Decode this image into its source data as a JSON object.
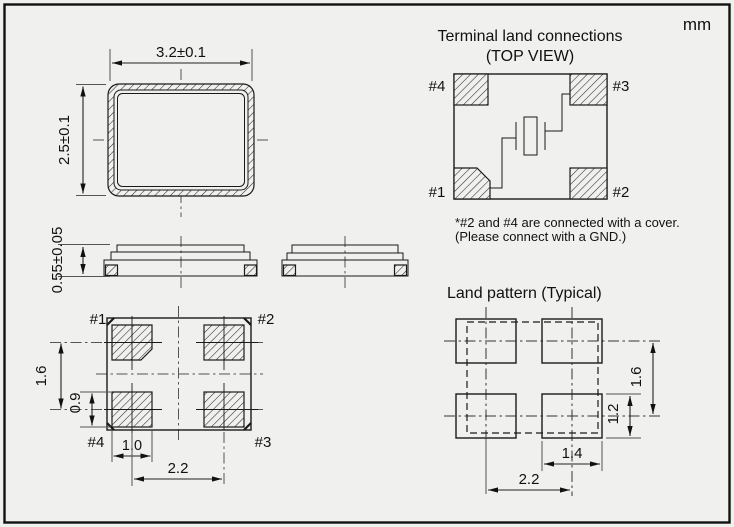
{
  "units_label": "mm",
  "package_top_view": {
    "width_dim": "3.2±0.1",
    "height_dim": "2.5±0.1"
  },
  "package_side_view": {
    "height_dim": "0.55±0.05"
  },
  "package_bottom_view": {
    "pad_labels": {
      "top_left": "#1",
      "top_right": "#2",
      "bottom_left": "#4",
      "bottom_right": "#3"
    },
    "dims": {
      "row_pitch": "1.6",
      "pad_height": "0.9",
      "pad_width": "1.0",
      "column_pitch": "2.2"
    }
  },
  "terminal_land_connections": {
    "title": "Terminal land connections",
    "subtitle": "(TOP VIEW)",
    "pad_labels": {
      "top_left": "#4",
      "top_right": "#3",
      "bottom_left": "#1",
      "bottom_right": "#2"
    },
    "note_line1": "*#2 and #4 are connected with a cover.",
    "note_line2": "(Please connect with a GND.)"
  },
  "land_pattern": {
    "title": "Land pattern (Typical)",
    "dims": {
      "row_pitch": "1.6",
      "pad_height": "1.2",
      "pad_width": "1.4",
      "column_pitch": "2.2"
    }
  },
  "colors": {
    "background": "#f0f0ee",
    "line": "#1a1a1a",
    "centerline": "#555555"
  }
}
